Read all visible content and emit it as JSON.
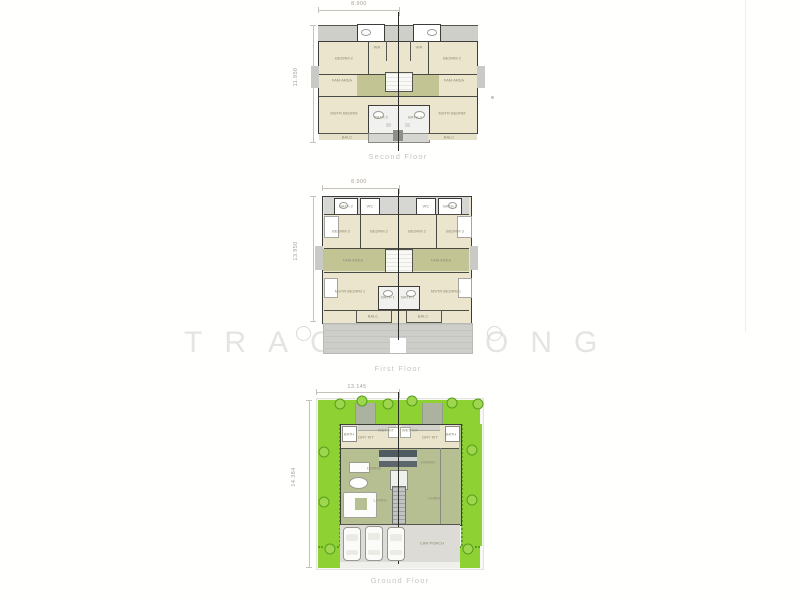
{
  "watermark": {
    "left": "TRAC",
    "right": "ONG"
  },
  "plans": [
    {
      "id": "second-floor",
      "title": "Second Floor",
      "dim_top": "8.900",
      "dim_left": "11.950"
    },
    {
      "id": "first-floor",
      "title": "First Floor",
      "dim_top": "8.900",
      "dim_left": "13.950"
    },
    {
      "id": "ground-floor",
      "title": "Ground Floor",
      "dim_top": "13.145",
      "dim_left": "14.384"
    }
  ],
  "room_labels": [
    {
      "t": "BEDRM 2",
      "x": 344,
      "y": 58
    },
    {
      "t": "BEDRM 2",
      "x": 452,
      "y": 58
    },
    {
      "t": "WR",
      "x": 377,
      "y": 47
    },
    {
      "t": "WR",
      "x": 419,
      "y": 47
    },
    {
      "t": "FAM AREA",
      "x": 342,
      "y": 80
    },
    {
      "t": "FAM AREA",
      "x": 454,
      "y": 80
    },
    {
      "t": "MSTR BEDRM",
      "x": 344,
      "y": 113
    },
    {
      "t": "MSTR BEDRM",
      "x": 452,
      "y": 113
    },
    {
      "t": "BATH 2",
      "x": 381,
      "y": 117
    },
    {
      "t": "BATH 2",
      "x": 415,
      "y": 117
    },
    {
      "t": "BALC",
      "x": 347,
      "y": 137
    },
    {
      "t": "BALC",
      "x": 449,
      "y": 137
    },
    {
      "t": "BATH 2",
      "x": 346,
      "y": 206
    },
    {
      "t": "WC",
      "x": 370,
      "y": 206
    },
    {
      "t": "WC",
      "x": 426,
      "y": 206
    },
    {
      "t": "BATH 2",
      "x": 450,
      "y": 206
    },
    {
      "t": "BEDRM 3",
      "x": 341,
      "y": 231
    },
    {
      "t": "BEDRM 2",
      "x": 379,
      "y": 231
    },
    {
      "t": "BEDRM 2",
      "x": 417,
      "y": 231
    },
    {
      "t": "BEDRM 3",
      "x": 455,
      "y": 231
    },
    {
      "t": "FAM AREA",
      "x": 353,
      "y": 260
    },
    {
      "t": "FAM AREA",
      "x": 441,
      "y": 260
    },
    {
      "t": "MSTR BEDRM 1",
      "x": 350,
      "y": 291
    },
    {
      "t": "MSTR BEDRM 1",
      "x": 446,
      "y": 291
    },
    {
      "t": "BATH 1",
      "x": 388,
      "y": 297
    },
    {
      "t": "BATH 1",
      "x": 408,
      "y": 297
    },
    {
      "t": "BALC",
      "x": 373,
      "y": 316
    },
    {
      "t": "BALC",
      "x": 423,
      "y": 316
    },
    {
      "t": "BATH",
      "x": 349,
      "y": 434
    },
    {
      "t": "DRY KIT",
      "x": 366,
      "y": 437
    },
    {
      "t": "WET KIT",
      "x": 386,
      "y": 430
    },
    {
      "t": "WET KIT",
      "x": 410,
      "y": 430
    },
    {
      "t": "DRY KIT",
      "x": 430,
      "y": 437
    },
    {
      "t": "BATH",
      "x": 451,
      "y": 434
    },
    {
      "t": "DINING",
      "x": 374,
      "y": 468
    },
    {
      "t": "DINING",
      "x": 428,
      "y": 462
    },
    {
      "t": "LIVING",
      "x": 380,
      "y": 500
    },
    {
      "t": "LIVING",
      "x": 434,
      "y": 498
    },
    {
      "t": "CAR PORCH",
      "x": 432,
      "y": 543
    }
  ],
  "ground": {
    "trees": [
      [
        340,
        404
      ],
      [
        362,
        401
      ],
      [
        388,
        404
      ],
      [
        412,
        401
      ],
      [
        452,
        403
      ],
      [
        478,
        404
      ],
      [
        324,
        452
      ],
      [
        324,
        502
      ],
      [
        330,
        549
      ],
      [
        472,
        450
      ],
      [
        472,
        500
      ],
      [
        468,
        549
      ]
    ]
  },
  "colors": {
    "room_cream": "#eae5cc",
    "accent_olive": "#c3c494",
    "landscape_green": "#8ed133",
    "roof_gray": "#cfcfca",
    "wall_dark": "#3c3c38",
    "ground_sage": "#b6bf92"
  }
}
